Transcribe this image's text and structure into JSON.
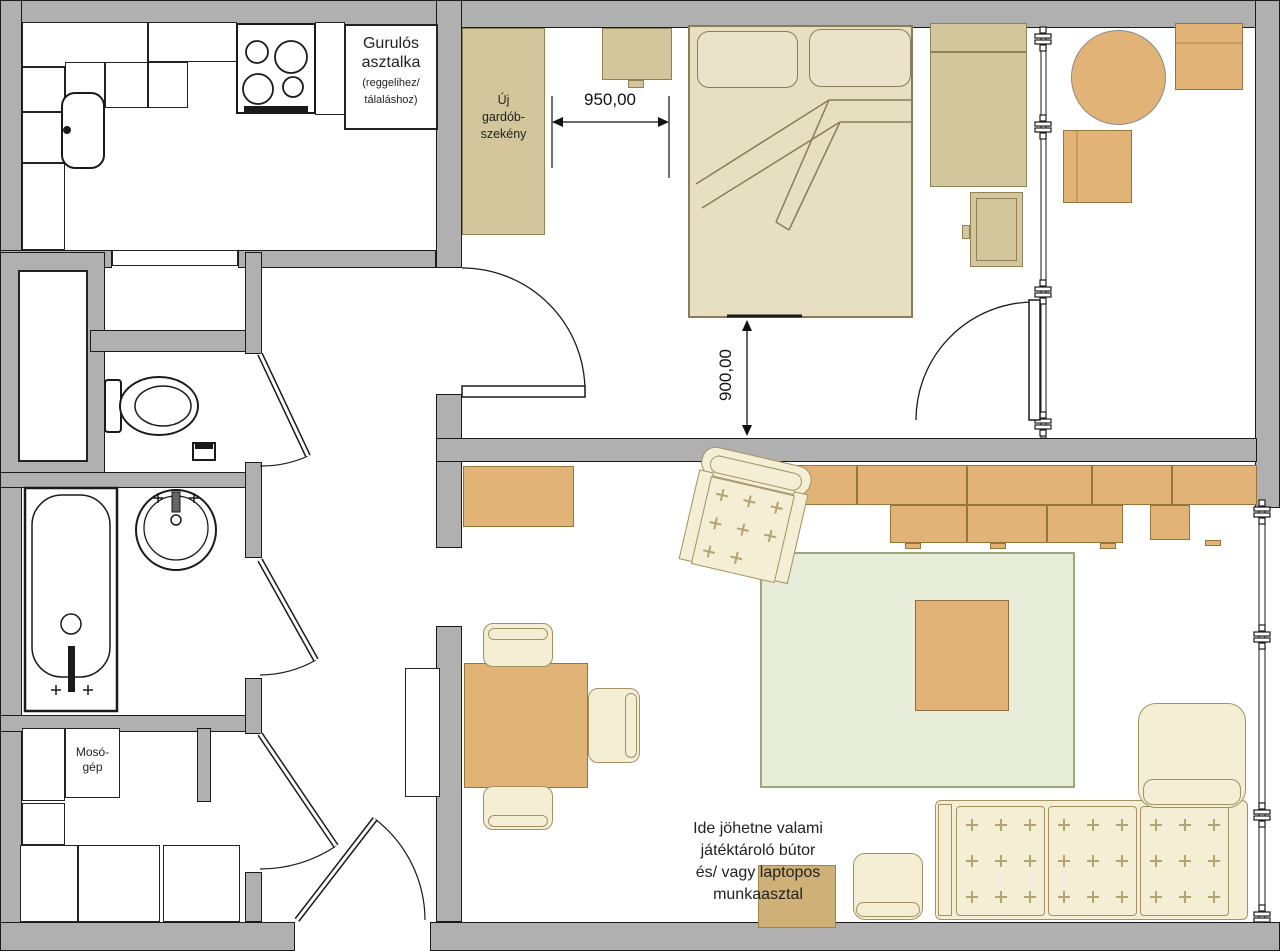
{
  "plan": {
    "rolling_table_label": {
      "line1": "Gurulós",
      "line2": "asztalka",
      "line3": "(reggelihez/",
      "line4": "tálaláshoz)"
    },
    "wardrobe_label": {
      "line1": "Új",
      "line2": "gardób-",
      "line3": "szekény"
    },
    "washer_label": {
      "line1": "Mosó-",
      "line2": "gép"
    },
    "suggestion_note": {
      "line1": "Ide jöhetne valami",
      "line2": "játéktároló bútor",
      "line3": "és/ vagy laptopos",
      "line4": "munkaasztal"
    },
    "dimensions": {
      "wardrobe_to_bed": "950,00",
      "bed_to_wall": "900,00"
    }
  },
  "colors": {
    "wall": "#b0b0b0",
    "outline": "#1a1a1a",
    "wood_orange": "#e2b377",
    "khaki": "#d3c69c",
    "bed": "#e6dfc1",
    "cream": "#f4eed4",
    "rug": "#e8edda",
    "laptop_square": "#cfb077"
  }
}
